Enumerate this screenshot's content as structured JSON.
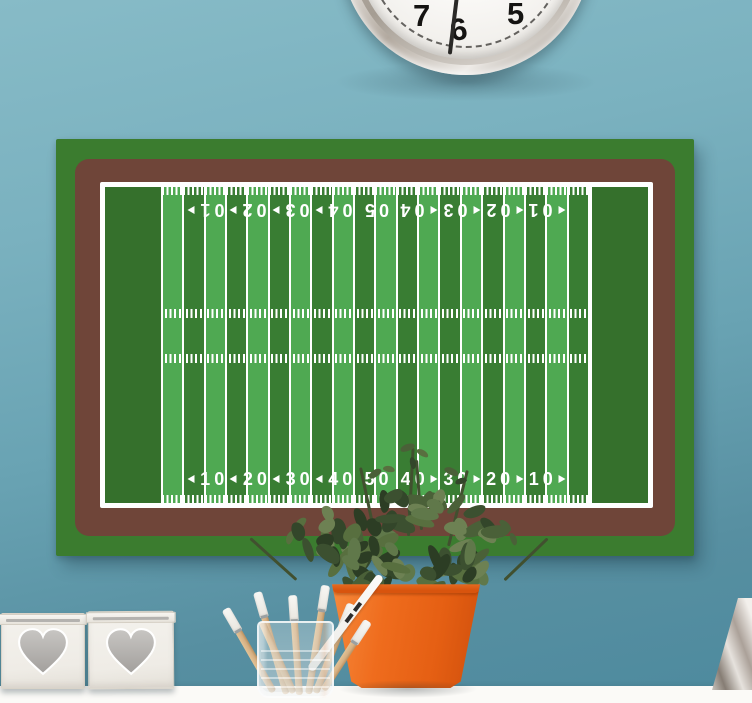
{
  "scene": {
    "wall_color_top": "#87bbc7",
    "wall_color_bottom": "#4d8a9e",
    "shelf_color": "#fbfaf7"
  },
  "clock": {
    "numbers": [
      "7",
      "6",
      "5"
    ],
    "face_color": "#f7f5f2",
    "rim_color": "#c6bfb6"
  },
  "poster": {
    "background_color": "#3b7c2f",
    "frame_color": "#6f4539",
    "field": {
      "boundary_color": "#ffffff",
      "endzone_color": "#35702c",
      "stripe_light": "#4fa952",
      "stripe_dark": "#397d33",
      "stripe_count": 20,
      "yard_numbers": [
        "10",
        "20",
        "30",
        "40",
        "50",
        "40",
        "30",
        "20",
        "10"
      ]
    }
  },
  "decor": {
    "pot_color": "#ef6c1d",
    "plant_color": "#4a6038",
    "brush_handle_color": "#d6b083",
    "brush_tip_color": "#f3f1ec",
    "heart_box_color": "#f2f0eb",
    "heart_inlay_color": "#b5b3b0"
  }
}
